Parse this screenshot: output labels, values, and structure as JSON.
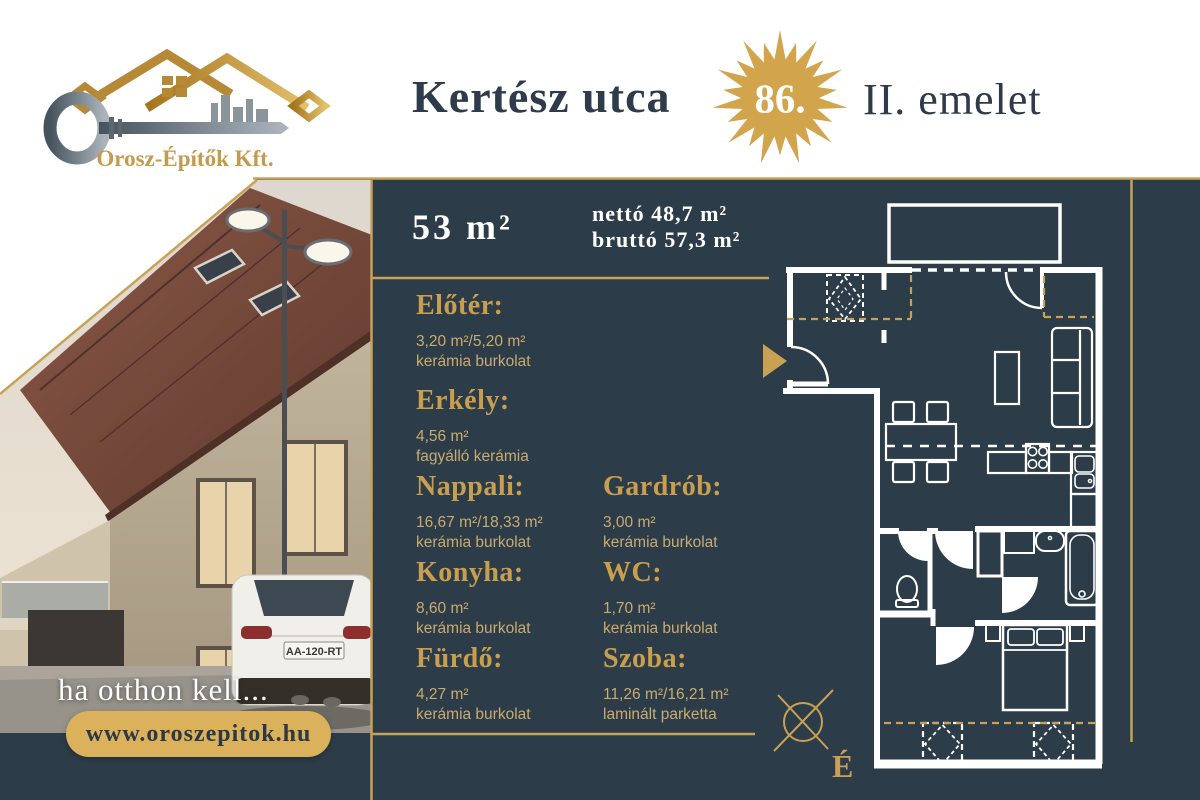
{
  "colors": {
    "panel": "#2d3c49",
    "gold_line": "#c8a257",
    "gold_heading": "#c99f4e",
    "gold_body": "#c9ab70",
    "starburst_gold": "#d2a44c",
    "pill_gold": "#dcb15c",
    "title_ink": "#2d3b4a",
    "plan_lines": "#ffffff"
  },
  "logo": {
    "company": "Orosz-Építők Kft."
  },
  "header": {
    "street": "Kertész utca",
    "house_number": "86.",
    "floor": "II. emelet"
  },
  "summary": {
    "total": "53 m²",
    "net": "nettó 48,7 m²",
    "gross": "bruttó 57,3 m²"
  },
  "rooms": [
    {
      "name": "Előtér:",
      "area": "3,20 m²/5,20 m²",
      "finish": "kerámia burkolat"
    },
    {
      "name": "Erkély:",
      "area": "4,56 m²",
      "finish": "fagyálló kerámia"
    },
    {
      "name": "Nappali:",
      "area": "16,67 m²/18,33 m²",
      "finish": "kerámia burkolat"
    },
    {
      "name": "Konyha:",
      "area": "8,60 m²",
      "finish": "kerámia burkolat"
    },
    {
      "name": "Fürdő:",
      "area": "4,27 m²",
      "finish": "kerámia burkolat"
    },
    {
      "name": "Gardrób:",
      "area": "3,00 m²",
      "finish": "kerámia burkolat"
    },
    {
      "name": "WC:",
      "area": "1,70 m²",
      "finish": "kerámia burkolat"
    },
    {
      "name": "Szoba:",
      "area": "11,26 m²/16,21 m²",
      "finish": "laminált parketta"
    }
  ],
  "photo": {
    "tagline": "ha otthon kell...",
    "website": "www.oroszepitok.hu",
    "license_plate": "AA-120-RT"
  },
  "floorplan": {
    "compass": "É"
  }
}
